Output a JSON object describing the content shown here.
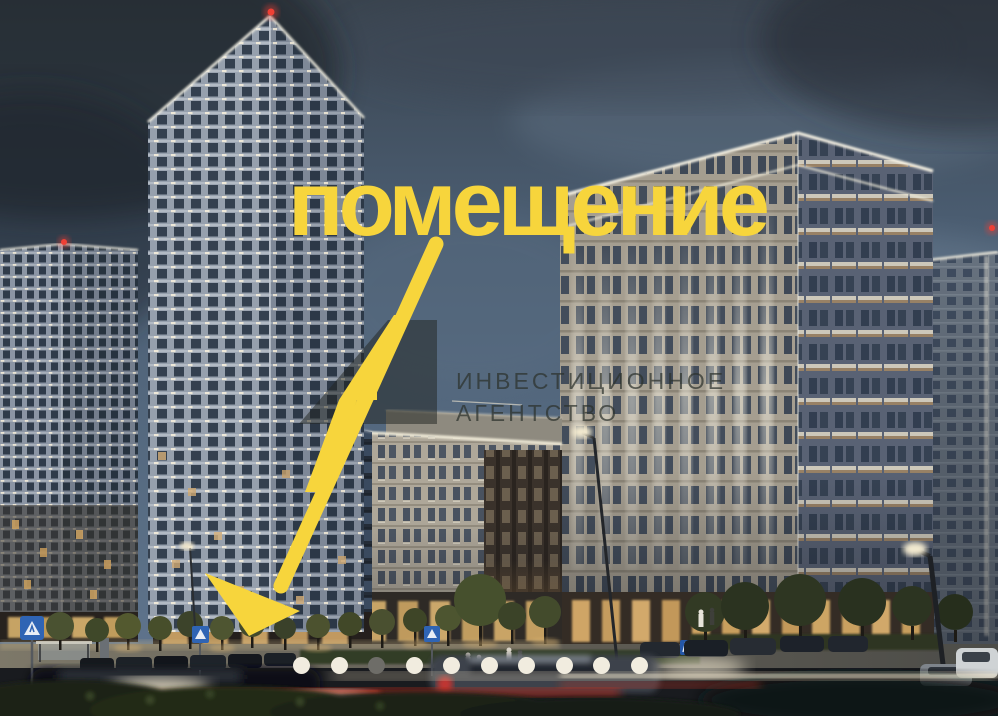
{
  "colors": {
    "accent": "#F7D53C",
    "watermark": "rgba(44,50,45,0.72)",
    "gallery_dot": "#F1ECDF",
    "gallery_dot_active": "#6E6D68",
    "beacon_red": "#EF4136"
  },
  "annotation": {
    "headline": "помещение"
  },
  "watermark": {
    "line1": "ИНВЕСТИЦИОННОЕ",
    "line2": "АГЕНТСТВО"
  },
  "gallery": {
    "dot_count": 10,
    "active_index": 2
  }
}
